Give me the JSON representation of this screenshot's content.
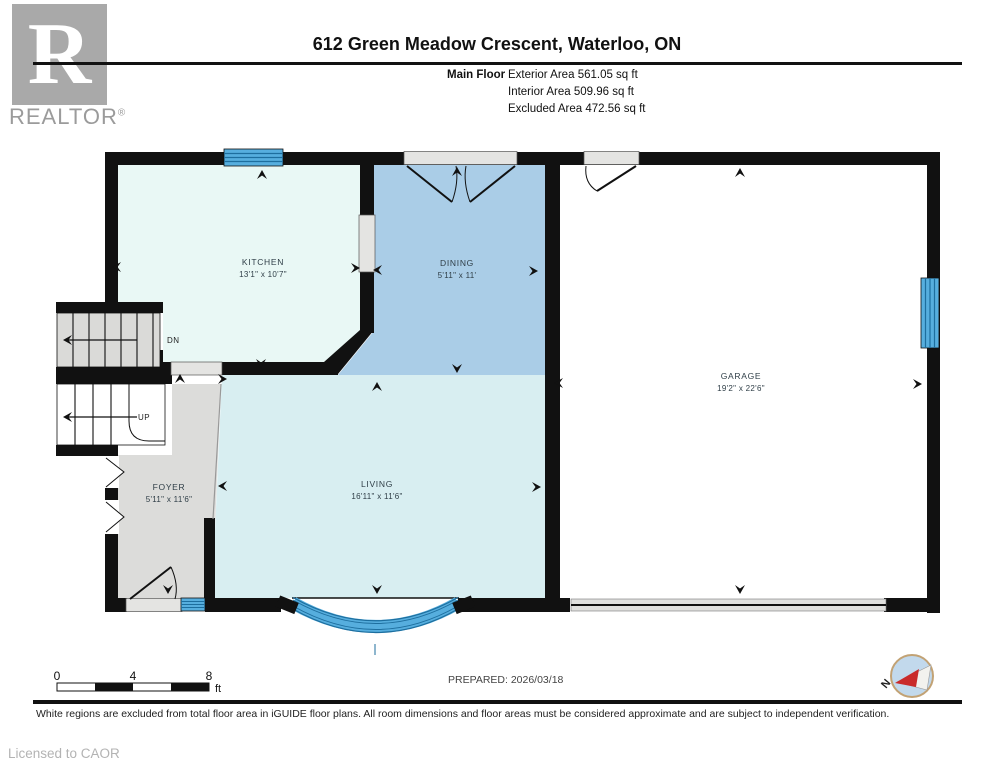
{
  "header": {
    "logo": {
      "letter": "R",
      "brand": "REALTOR",
      "registered": "®"
    },
    "title": "612 Green Meadow Crescent, Waterloo, ON",
    "floor_label": "Main Floor",
    "stats": [
      {
        "label": "Exterior Area",
        "value": "561.05 sq ft"
      },
      {
        "label": "Interior Area",
        "value": "509.96 sq ft"
      },
      {
        "label": "Excluded Area",
        "value": "472.56 sq ft"
      }
    ]
  },
  "rooms": {
    "kitchen": {
      "name": "KITCHEN",
      "dims": "13'1\" x 10'7\""
    },
    "dining": {
      "name": "DINING",
      "dims": "5'11\" x 11'"
    },
    "garage": {
      "name": "GARAGE",
      "dims": "19'2\" x 22'6\""
    },
    "foyer": {
      "name": "FOYER",
      "dims": "5'11\" x 11'6\""
    },
    "living": {
      "name": "LIVING",
      "dims": "16'11\" x 11'6\""
    }
  },
  "stairs": {
    "down_label": "DN",
    "up_label": "UP"
  },
  "scale_bar": {
    "ticks": [
      "0",
      "4",
      "8"
    ],
    "unit": "ft"
  },
  "prepared": "PREPARED: 2026/03/18",
  "compass": {
    "north_label": "N"
  },
  "footer": {
    "disclaimer": "White regions are excluded from total floor area in iGUIDE floor plans. All room dimensions and floor areas must be considered approximate and are subject to independent verification.",
    "license": "Licensed to CAOR"
  },
  "colors": {
    "wall": "#111111",
    "window_blue": "#56aede",
    "window_stripe": "#1d6e9e",
    "kitchen_fill": "#e9f8f5",
    "living_fill": "#d8eef1",
    "dining_fill": "#aacde7",
    "foyer_fill": "#dcdcda",
    "garage_fill": "#ffffff",
    "opening_gray": "#e4e4e2",
    "compass_red": "#c92b2b"
  }
}
